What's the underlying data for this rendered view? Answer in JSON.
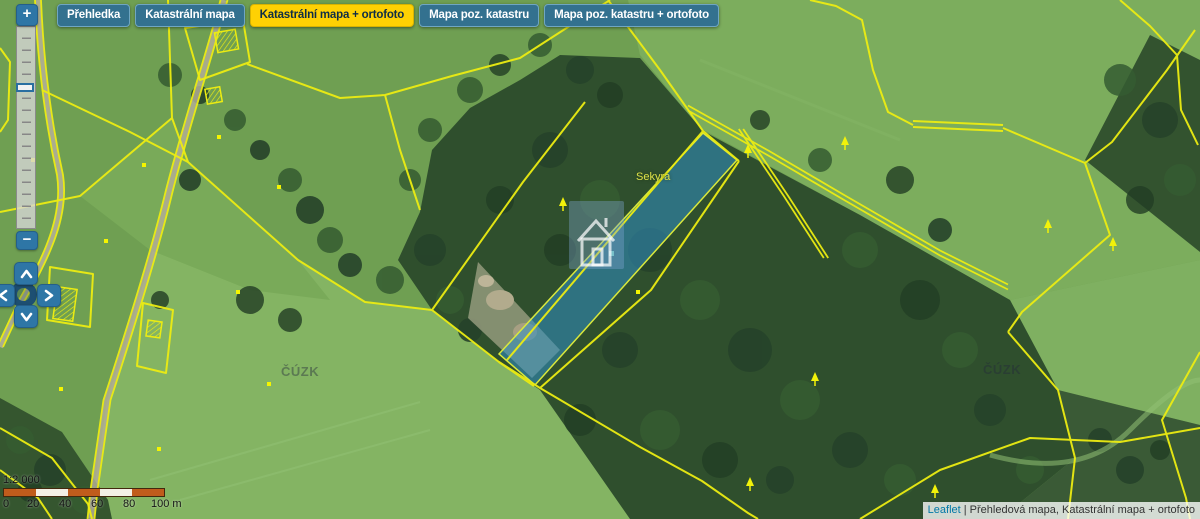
{
  "basemap_tabs": [
    {
      "label": "Přehledka",
      "active": false
    },
    {
      "label": "Katastrální mapa",
      "active": false
    },
    {
      "label": "Katastrální mapa + ortofoto",
      "active": true
    },
    {
      "label": "Mapa poz. katastru",
      "active": false
    },
    {
      "label": "Mapa poz. katastru + ortofoto",
      "active": false
    }
  ],
  "zoom_control": {
    "zoom_in_label": "+",
    "zoom_out_label": "−"
  },
  "pan_control": {
    "icons": [
      "chevron-up",
      "chevron-left",
      "chevron-right",
      "chevron-down",
      "compass-ring"
    ]
  },
  "scale_control": {
    "ratio_label": "1:2 000",
    "tick_labels": [
      "0",
      "20",
      "40",
      "60",
      "80",
      "100 m"
    ]
  },
  "attribution": {
    "library_link": "Leaflet",
    "separator": "|",
    "layers_label": "Přehledová mapa, Katastrální mapa + ortofoto"
  },
  "map_annotations": {
    "parcel_name": "Sekyra",
    "watermarks": [
      "ČÚZK",
      "ČÚZK"
    ]
  },
  "colors": {
    "tab_active_bg": "#ffd103",
    "tab_active_text": "#0e2d47",
    "tab_bg": "#33718f",
    "control_blue": "#2e76a6",
    "boundary_yellow": "#ecec12",
    "parcel_highlight_fill": "#2f8fc4",
    "scale_orange": "#c05c1c",
    "leaflet_link": "#0078a8"
  }
}
